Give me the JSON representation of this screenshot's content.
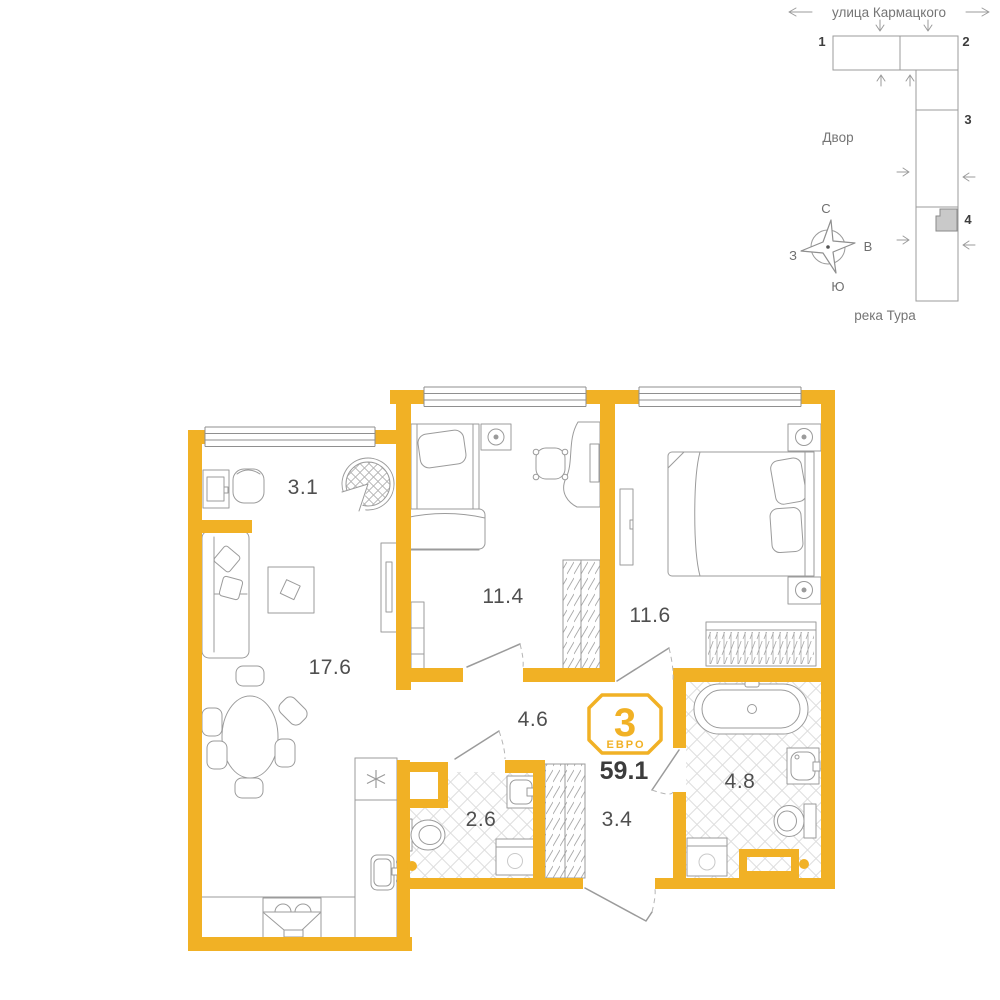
{
  "palette": {
    "wall_yellow": "#F1B125",
    "furniture_line": "#9B9B9B",
    "tile_line": "#DEDEDE",
    "room_label": "#4F4F4F",
    "site_text": "#757575",
    "dark_text": "#3C3C3C",
    "selected_unit_fill": "#C9C9C9"
  },
  "site_plan": {
    "street_label": "улица Кармацкого",
    "courtyard_label": "Двор",
    "river_label": "река Тура",
    "section_labels": [
      "1",
      "2",
      "3",
      "4"
    ],
    "compass": {
      "north": "С",
      "east": "В",
      "south": "Ю",
      "west": "З"
    }
  },
  "floor_plan": {
    "badge": {
      "rooms_count": "3",
      "plan_type": "ЕВРО",
      "total_area": "59.1"
    },
    "rooms": [
      {
        "name": "loggia",
        "area": "3.1"
      },
      {
        "name": "living-kitchen",
        "area": "17.6"
      },
      {
        "name": "bedroom-1",
        "area": "11.4"
      },
      {
        "name": "bedroom-2",
        "area": "11.6"
      },
      {
        "name": "hallway",
        "area": "4.6"
      },
      {
        "name": "wc",
        "area": "2.6"
      },
      {
        "name": "corridor",
        "area": "3.4"
      },
      {
        "name": "bathroom",
        "area": "4.8"
      }
    ]
  }
}
